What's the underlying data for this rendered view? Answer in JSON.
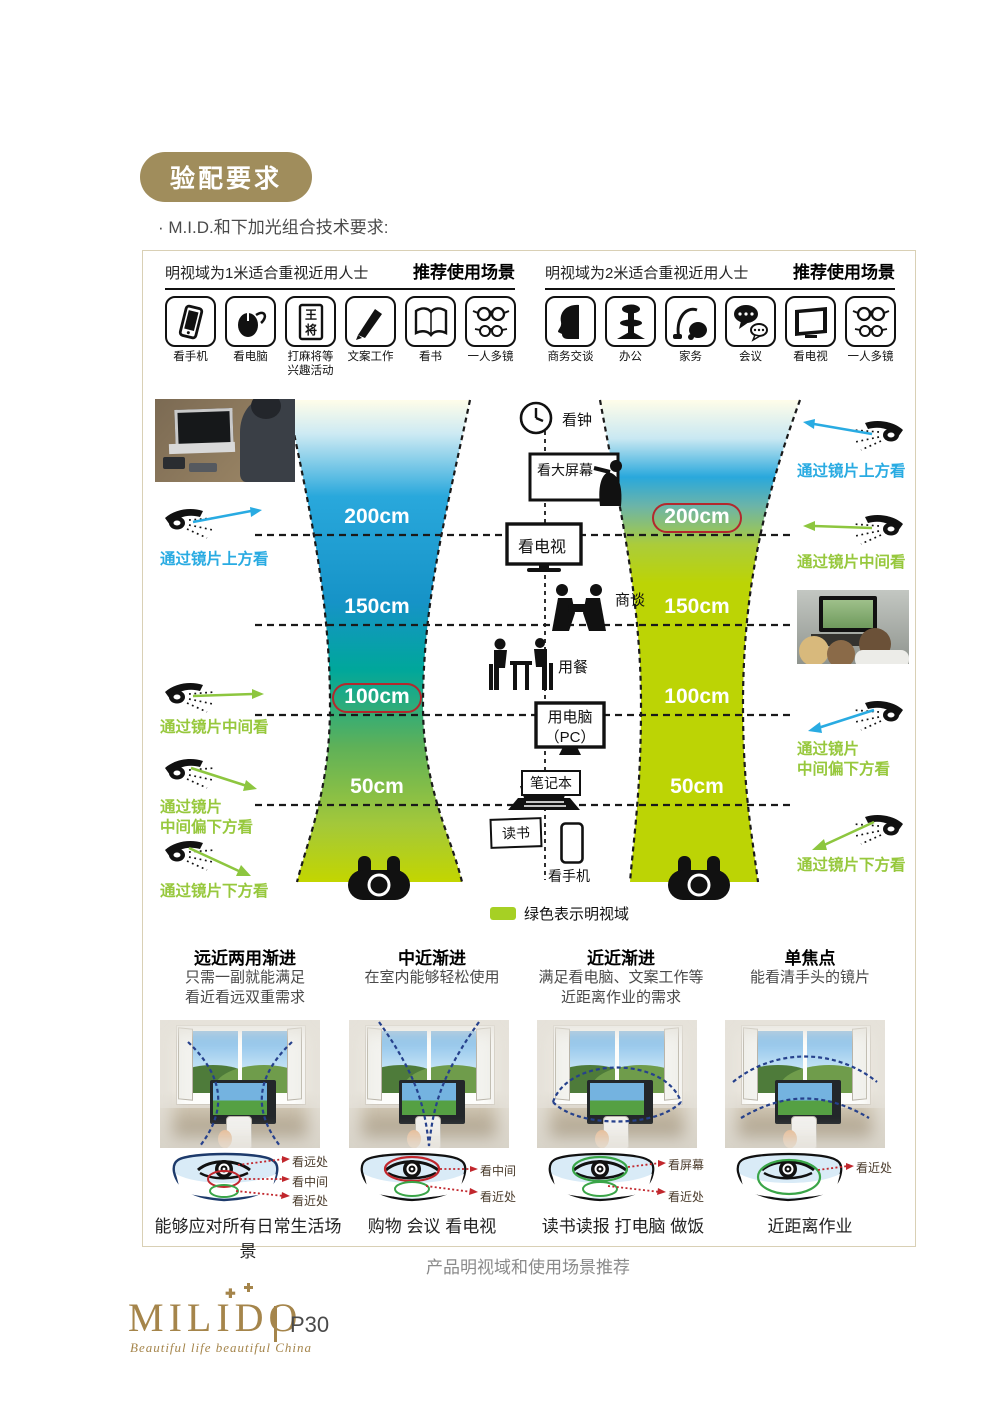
{
  "page": {
    "badge": "验配要求",
    "subtitle": "· M.I.D.和下加光组合技术要求:",
    "diagram_caption": "产品明视域和使用场景推荐",
    "footer": {
      "brand": "MILIDO",
      "tagline": "Beautiful life beautiful China",
      "page_number": "P30"
    }
  },
  "colors": {
    "accent_gold": "#a08d5c",
    "blue": "#29abe2",
    "green": "#8dc63f",
    "lime": "#c3d600",
    "teal": "#00a99d",
    "red_circle": "#b3282d",
    "navy_dash": "#26418c"
  },
  "panels": [
    {
      "header": "明视域为1米适合重视近用人士",
      "scenes_title": "推荐使用场景",
      "icons": [
        {
          "icon": "phone-icon",
          "label": "看手机"
        },
        {
          "icon": "mouse-icon",
          "label": "看电脑"
        },
        {
          "icon": "mahjong-icon",
          "label": "打麻将等兴趣活动",
          "g1": "王",
          "g2": "将"
        },
        {
          "icon": "pen-icon",
          "label": "文案工作"
        },
        {
          "icon": "book-icon",
          "label": "看书"
        },
        {
          "icon": "glasses-icon",
          "label": "一人多镜"
        }
      ]
    },
    {
      "header": "明视域为2米适合重视近用人士",
      "scenes_title": "推荐使用场景",
      "icons": [
        {
          "icon": "profile-icon",
          "label": "商务交谈"
        },
        {
          "icon": "chair-icon",
          "label": "办公"
        },
        {
          "icon": "vacuum-icon",
          "label": "家务"
        },
        {
          "icon": "chat-icon",
          "label": "会议"
        },
        {
          "icon": "tv-icon",
          "label": "看电视"
        },
        {
          "icon": "glasses-icon",
          "label": "一人多镜"
        }
      ]
    }
  ],
  "diagram": {
    "left_distances": [
      "200cm",
      "150cm",
      "100cm",
      "50cm"
    ],
    "right_distances": [
      "200cm",
      "150cm",
      "100cm",
      "50cm"
    ],
    "left_circled_index": 2,
    "right_circled_index": 0,
    "activities": {
      "clock": "看钟",
      "bigscreen": "看大屏幕",
      "tv": "看电视",
      "talk": "商谈",
      "dine": "用餐",
      "pc1": "用电脑",
      "pc2": "（PC）",
      "laptop": "笔记本",
      "read": "读书",
      "phone": "看手机"
    },
    "legend": "绿色表示明视域",
    "ann_left": [
      {
        "l1": "通过镜片上方看",
        "l2": ""
      },
      {
        "l1": "通过镜片中间看",
        "l2": ""
      },
      {
        "l1": "通过镜片",
        "l2": "中间偏下方看"
      },
      {
        "l1": "通过镜片下方看",
        "l2": ""
      }
    ],
    "ann_right": [
      {
        "l1": "通过镜片上方看",
        "l2": ""
      },
      {
        "l1": "通过镜片中间看",
        "l2": ""
      },
      {
        "l1": "通过镜片",
        "l2": "中间偏下方看"
      },
      {
        "l1": "通过镜片下方看",
        "l2": ""
      }
    ]
  },
  "lens_types": [
    {
      "title": "远近两用渐进",
      "desc": [
        "只需一副就能满足",
        "看近看远双重需求"
      ],
      "labels": [
        "看远处",
        "看中间",
        "看近处"
      ],
      "caption": "能够应对所有日常生活场景"
    },
    {
      "title": "中近渐进",
      "desc": [
        "在室内能够轻松使用",
        ""
      ],
      "labels": [
        "看中间",
        "看近处"
      ],
      "caption": "购物 会议 看电视"
    },
    {
      "title": "近近渐进",
      "desc": [
        "满足看电脑、文案工作等",
        "近距离作业的需求"
      ],
      "labels": [
        "看屏幕",
        "看近处"
      ],
      "caption": "读书读报 打电脑 做饭"
    },
    {
      "title": "单焦点",
      "desc": [
        "能看清手头的镜片",
        ""
      ],
      "labels": [
        "看近处"
      ],
      "caption": "近距离作业"
    }
  ]
}
